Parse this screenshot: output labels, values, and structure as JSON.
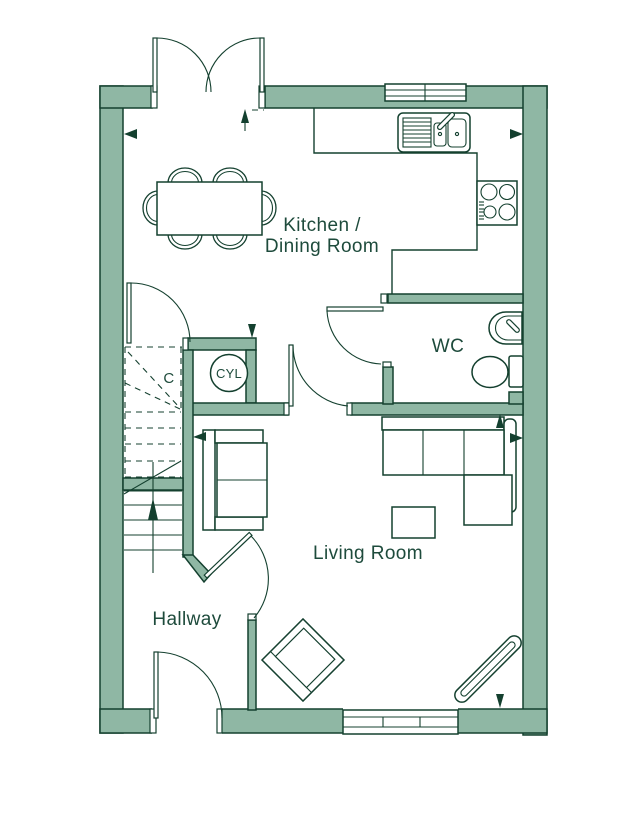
{
  "colors": {
    "wall_fill": "#8FB7A4",
    "line": "#14402F",
    "text": "#1E4B3C"
  },
  "rooms": {
    "kitchen_line1": "Kitchen /",
    "kitchen_line2": "Dining Room",
    "wc": "WC",
    "living": "Living Room",
    "hallway": "Hallway",
    "cupboard": "C",
    "cylinder": "CYL"
  }
}
